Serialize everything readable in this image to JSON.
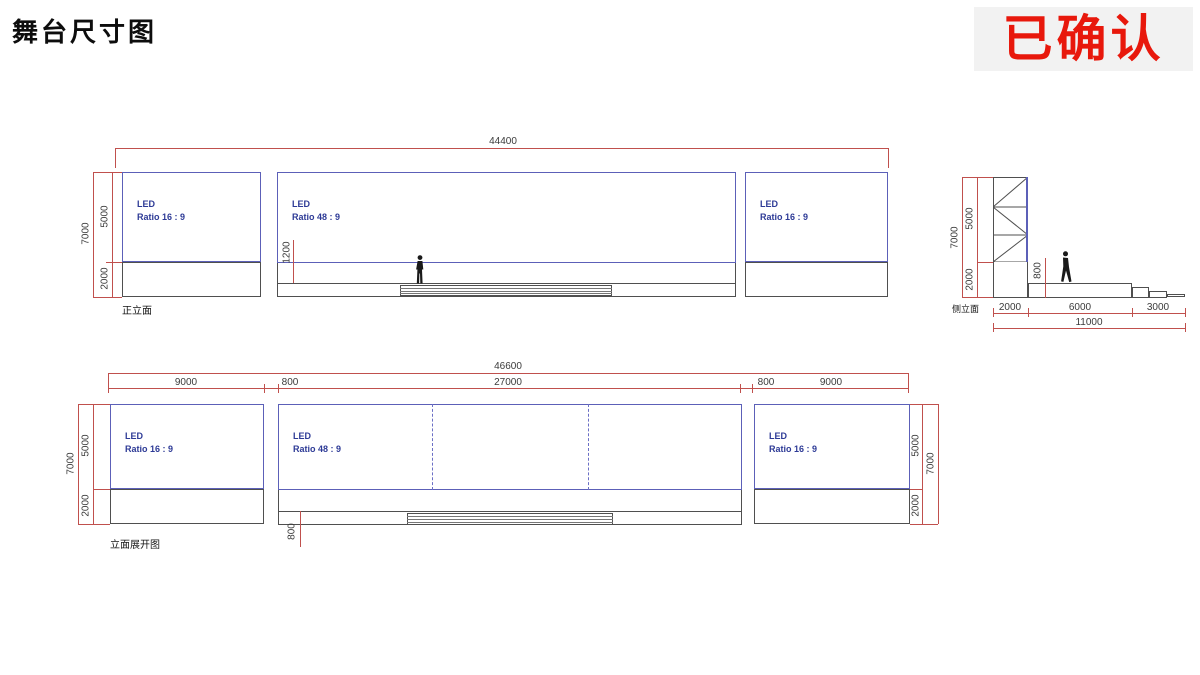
{
  "slide": {
    "title": "舞台尺寸图",
    "stamp": "已确认"
  },
  "colors": {
    "dimension_red": "#c0504d",
    "led_border_blue": "#5c60b8",
    "led_text_blue": "#2d3a96",
    "structure_gray": "#4f4f4f",
    "stamp_red": "#e8180c",
    "stamp_bg": "#f2f2f2"
  },
  "front": {
    "label": "正立面",
    "led_left": {
      "line1": "LED",
      "line2": "Ratio 16 : 9"
    },
    "led_center": {
      "line1": "LED",
      "line2": "Ratio 48 : 9"
    },
    "led_right": {
      "line1": "LED",
      "line2": "Ratio 16 : 9"
    },
    "dims": {
      "total_width": "44400",
      "height_total": "7000",
      "height_led": "5000",
      "height_base": "2000",
      "led_clearance": "1200"
    }
  },
  "side": {
    "label": "侧立面",
    "dims": {
      "height_total": "7000",
      "height_led": "5000",
      "height_base": "2000",
      "stage_height": "800",
      "tower_depth": "2000",
      "stage_depth": "6000",
      "steps_depth": "3000",
      "total_depth": "11000"
    }
  },
  "expanded": {
    "label": "立面展开图",
    "led_left": {
      "line1": "LED",
      "line2": "Ratio 16 : 9"
    },
    "led_center": {
      "line1": "LED",
      "line2": "Ratio 48 : 9"
    },
    "led_right": {
      "line1": "LED",
      "line2": "Ratio 16 : 9"
    },
    "dims": {
      "total_width": "46600",
      "left_width": "9000",
      "gap_left": "800",
      "center_width": "27000",
      "gap_right": "800",
      "right_width": "9000",
      "height_total_left": "7000",
      "height_led_left": "5000",
      "height_base_left": "2000",
      "stage_height": "800",
      "height_led_right": "5000",
      "height_base_right": "2000",
      "height_total_right": "7000"
    }
  }
}
